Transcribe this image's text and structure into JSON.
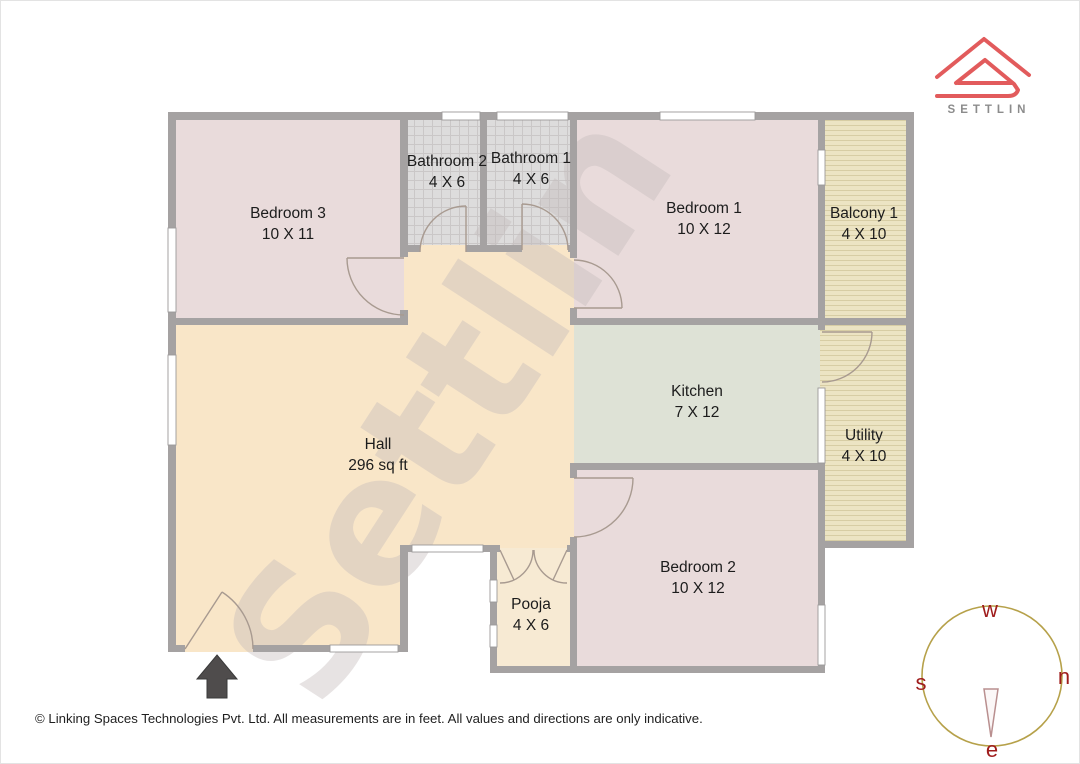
{
  "page": {
    "footer": "© Linking Spaces Technologies Pvt. Ltd. All measurements are in feet. All values and directions are only indicative.",
    "watermark": "Settlin"
  },
  "logo": {
    "brand": "SETTLIN"
  },
  "rooms": {
    "bedroom3": {
      "name": "Bedroom 3",
      "size": "10 X 11"
    },
    "bathroom2": {
      "name": "Bathroom 2",
      "size": "4 X 6"
    },
    "bathroom1": {
      "name": "Bathroom 1",
      "size": "4 X 6"
    },
    "bedroom1": {
      "name": "Bedroom 1",
      "size": "10 X 12"
    },
    "balcony1": {
      "name": "Balcony 1",
      "size": "4 X 10"
    },
    "kitchen": {
      "name": "Kitchen",
      "size": "7 X 12"
    },
    "utility": {
      "name": "Utility",
      "size": "4 X 10"
    },
    "hall": {
      "name": "Hall",
      "size": "296 sq ft"
    },
    "bedroom2": {
      "name": "Bedroom 2",
      "size": "10 X 12"
    },
    "pooja": {
      "name": "Pooja",
      "size": "4 X 6"
    }
  },
  "compass": {
    "top": "w",
    "right": "n",
    "bottom": "e",
    "left": "s"
  },
  "colors": {
    "bedroom": "#e9dbdb",
    "hall": "#f9e6c8",
    "pooja": "#f7ead3",
    "kitchen": "#dee2d6",
    "bathroom_tile": "#dddcdc",
    "bathroom_grid": "#cac7c7",
    "deck": "#ece4c3",
    "deck_stripe": "#d7cda4",
    "wall": "#a5a2a2",
    "watermark": "#c4bbbb",
    "logo_accent": "#e25b5c",
    "brand_text": "#8c8c8c",
    "compass_ring": "#b6a14a",
    "compass_letter": "#9f1c1c",
    "entrance_arrow": "#4f4c4c"
  }
}
